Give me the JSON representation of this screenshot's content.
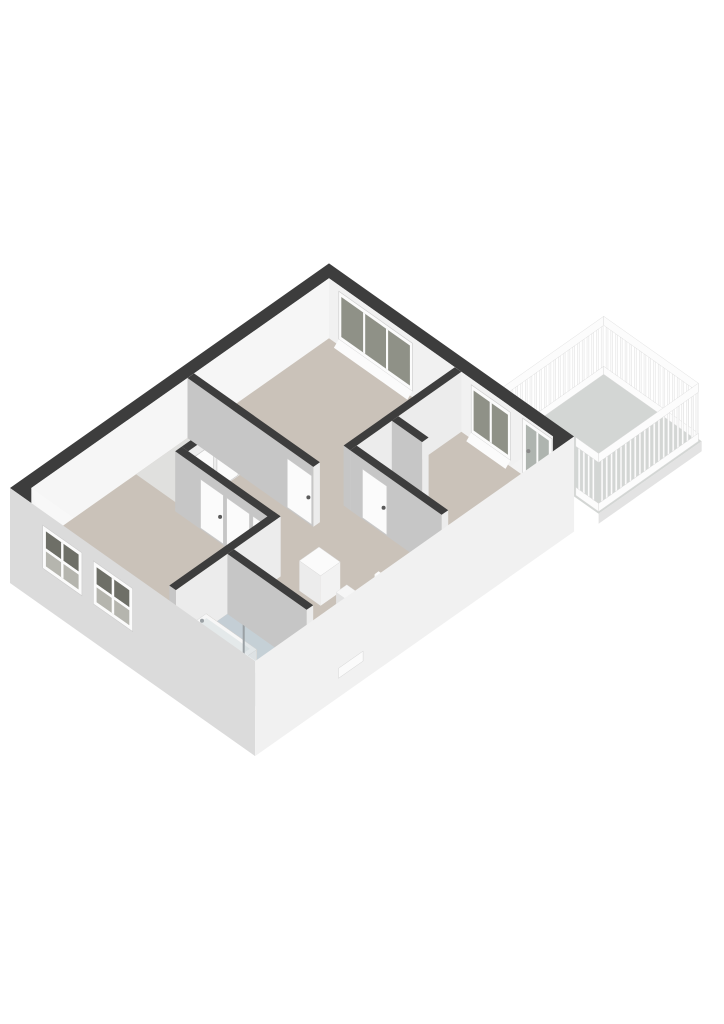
{
  "scene": {
    "kind": "isometric-3d-floorplan-render",
    "background": "#ffffff"
  },
  "iso": {
    "origin": [
      10,
      488
    ],
    "ex": [
      0.818,
      -0.576
    ],
    "ey": [
      0.817,
      0.577
    ],
    "wallHeight": 60,
    "facadeDepth": 35
  },
  "colors": {
    "wallTop": "#3d3d3d",
    "innerFaceNW": "#f6f6f6",
    "innerFaceNE": "#f1f1f1",
    "innerFaceSW": "#f8f8f8",
    "innerFaceSE": "#f3f3f3",
    "faceSW": "#c6c6c6",
    "faceSE": "#ececec",
    "extSW": "#dbdbdb",
    "extSE": "#f1f1f1",
    "floor": "#cac2b9",
    "floorBathroom": "#c4ced5",
    "floorCloset": "#e0e0de",
    "floorBalcony": "#d3d6d4",
    "balconyFascia": "#e3e3e3",
    "white": "#fbfbfb",
    "frameStroke": "#cccccc",
    "glassNE": "#8f9187",
    "glassDoor": "#aeb4af",
    "glassDark": "#6e6f67",
    "glassLow": "#b5b5ae",
    "showerGlass": "#c7d3d8",
    "wood": "#cf9c64",
    "woodDark": "#bb8751",
    "chrome": "#9aa0a4",
    "handle": "#5a5a5a",
    "tubRim": "#f7f7f7",
    "tubBasin": "#e4e9ea",
    "stairTread": "#f6f6f6",
    "stairRiser": "#e2e2e2",
    "stairStringer": "#efefef",
    "stairHole": "#aeaeae",
    "rail": "#fcfcfc",
    "railStroke": "#d9d9d9"
  },
  "building": {
    "outer": [
      0,
      0,
      390,
      300
    ],
    "inner": [
      13,
      13,
      377,
      287
    ]
  },
  "rooms": [
    {
      "id": "bedroom-1",
      "bounds": [
        212,
        13,
        377,
        167
      ]
    },
    {
      "id": "bedroom-2",
      "bounds": [
        249,
        183,
        377,
        287
      ]
    },
    {
      "id": "living-room",
      "bounds": [
        13,
        13,
        133,
        182
      ]
    },
    {
      "id": "hall",
      "bounds": [
        84,
        77,
        241,
        287
      ]
    },
    {
      "id": "closet",
      "bounds": [
        141,
        13,
        204,
        69
      ]
    },
    {
      "id": "bathroom",
      "bounds": [
        13,
        190,
        76,
        287
      ]
    },
    {
      "id": "balcony",
      "bounds": [
        390,
        210,
        516,
        330
      ]
    }
  ],
  "floors": [
    {
      "name": "floor-main",
      "rect": [
        13,
        13,
        377,
        287
      ],
      "color": "floor"
    },
    {
      "name": "floor-closet",
      "rect": [
        141,
        13,
        204,
        69
      ],
      "color": "floorCloset"
    },
    {
      "name": "floor-bathroom",
      "rect": [
        13,
        190,
        76,
        287
      ],
      "color": "floorBathroom"
    }
  ],
  "interiorWalls": [
    {
      "name": "wall-closet-front",
      "rect": [
        141,
        69,
        204,
        77
      ],
      "doors": [
        {
          "plane": "y",
          "at": 77,
          "span": [
            146,
            172
          ]
        },
        {
          "plane": "y",
          "at": 77,
          "span": [
            176,
            202
          ]
        }
      ]
    },
    {
      "name": "wall-living-room-east",
      "rect": [
        133,
        69,
        141,
        190
      ],
      "doors": [
        {
          "plane": "x",
          "at": 133,
          "span": [
            100,
            128
          ]
        },
        {
          "plane": "x",
          "at": 133,
          "span": [
            132,
            160
          ]
        },
        {
          "plane": "x",
          "at": 133,
          "span": [
            164,
            188
          ]
        }
      ]
    },
    {
      "name": "wall-bedroom-1-west",
      "rect": [
        204,
        13,
        212,
        167
      ],
      "doors": [
        {
          "plane": "x",
          "at": 204,
          "span": [
            135,
            165
          ]
        }
      ]
    },
    {
      "name": "wall-bedroom-divider",
      "rect": [
        241,
        167,
        377,
        175
      ],
      "doors": []
    },
    {
      "name": "wall-bedroom-2-niche",
      "rect": [
        292,
        175,
        300,
        212
      ],
      "doors": []
    },
    {
      "name": "wall-bedroom-2-west",
      "rect": [
        241,
        175,
        249,
        287
      ],
      "doors": [
        {
          "plane": "x",
          "at": 241,
          "span": [
            190,
            220
          ]
        }
      ]
    },
    {
      "name": "wall-living-room-south",
      "rect": [
        13,
        182,
        141,
        190
      ],
      "doors": []
    }
  ],
  "bathroomWall": {
    "name": "wall-bathroom-east",
    "rect": [
      76,
      190,
      84,
      287
    ],
    "doors": []
  },
  "windowsNE": [
    {
      "name": "window-bedroom-1",
      "panes": 3,
      "y": [
        28,
        112
      ],
      "mullions": [
        56,
        84
      ],
      "z": [
        10,
        50
      ]
    },
    {
      "name": "window-bedroom-2",
      "panes": 2,
      "y": [
        190,
        232
      ],
      "mullions": [
        211
      ],
      "z": [
        10,
        50
      ]
    }
  ],
  "balconyDoor": {
    "name": "balcony-door",
    "y": [
      250,
      286
    ],
    "z": [
      0,
      57
    ]
  },
  "windowsSW": [
    {
      "name": "window-facade-1",
      "y": [
        40,
        88
      ],
      "z": [
        3,
        46
      ]
    },
    {
      "name": "window-facade-2",
      "y": [
        102,
        150
      ],
      "z": [
        3,
        46
      ]
    }
  ],
  "balcony": {
    "rect": [
      390,
      210,
      516,
      330
    ],
    "railHeight": 58,
    "railings": [
      {
        "plane": "y",
        "at": 212,
        "from": 392,
        "to": 514
      },
      {
        "plane": "x",
        "at": 514,
        "from": 212,
        "to": 328
      },
      {
        "plane": "y",
        "at": 328,
        "from": 392,
        "to": 514
      }
    ],
    "stubRailing": {
      "plane": "x",
      "at": 392,
      "from": 300,
      "to": 328
    }
  },
  "bathtub": {
    "rect": [
      20,
      196,
      44,
      258
    ],
    "rimZ": 22
  },
  "shower": {
    "glassPlaneX": 52,
    "y": [
      234,
      284
    ],
    "height": 54,
    "pipeAt": [
      76,
      252
    ]
  },
  "hallCabinet": {
    "rect": [
      140,
      214,
      164,
      240
    ],
    "height": 30
  },
  "staircase": {
    "x": [
      108,
      176
    ],
    "y": [
      236,
      280
    ],
    "treads": 4,
    "treadDepth": 13,
    "treadDrop": 12
  },
  "facadeLedge": {
    "x": [
      102,
      132
    ],
    "z": [
      -16,
      -6
    ]
  }
}
